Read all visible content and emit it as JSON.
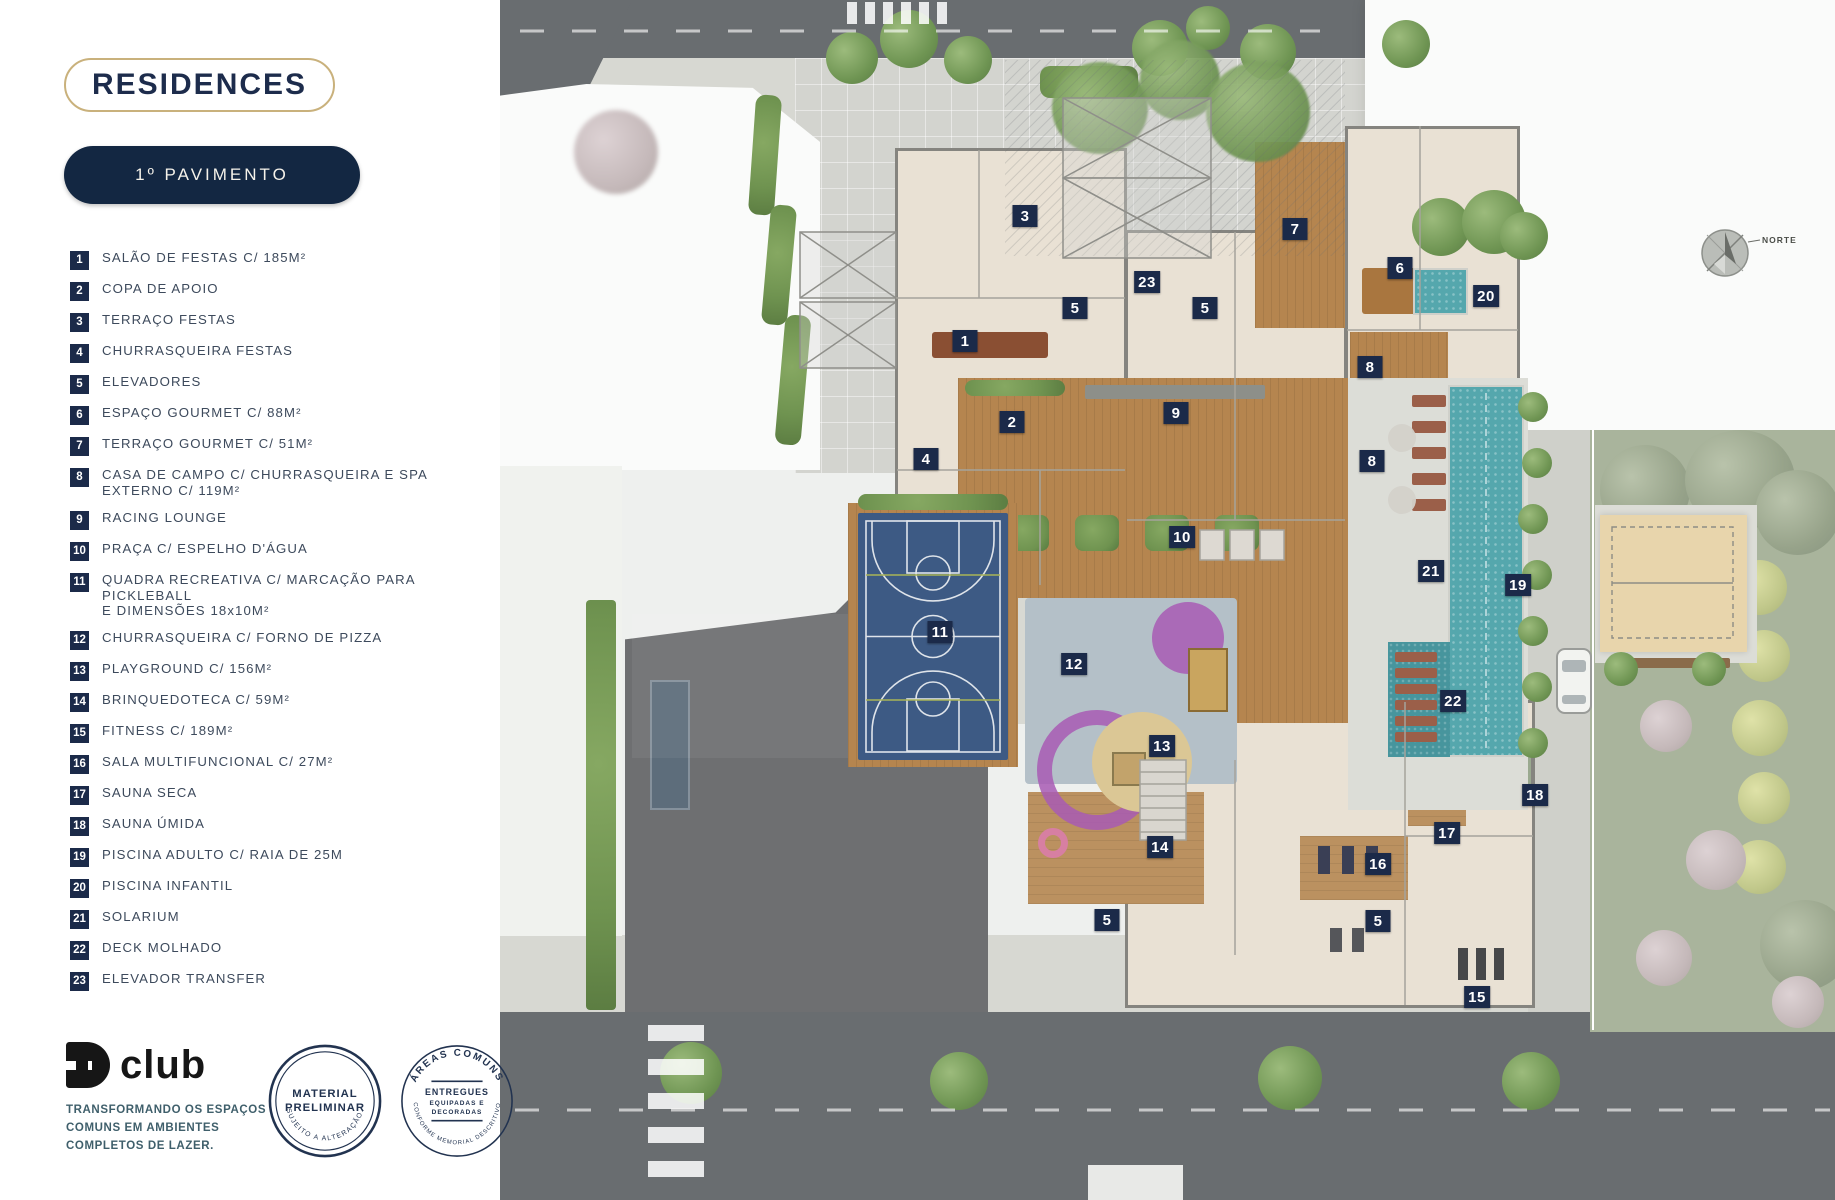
{
  "header": {
    "brand": "RESIDENCES",
    "floor_button": "1º PAVIMENTO"
  },
  "legend": {
    "items": [
      {
        "n": "1",
        "label": "SALÃO DE FESTAS C/ 185M²"
      },
      {
        "n": "2",
        "label": "COPA DE APOIO"
      },
      {
        "n": "3",
        "label": "TERRAÇO FESTAS"
      },
      {
        "n": "4",
        "label": "CHURRASQUEIRA FESTAS"
      },
      {
        "n": "5",
        "label": "ELEVADORES"
      },
      {
        "n": "6",
        "label": "ESPAÇO GOURMET C/ 88M²"
      },
      {
        "n": "7",
        "label": "TERRAÇO GOURMET C/ 51M²"
      },
      {
        "n": "8",
        "label": "CASA DE CAMPO C/ CHURRASQUEIRA E SPA EXTERNO C/ 119M²"
      },
      {
        "n": "9",
        "label": "RACING LOUNGE"
      },
      {
        "n": "10",
        "label": "PRAÇA C/ ESPELHO D'ÁGUA"
      },
      {
        "n": "11",
        "label": "QUADRA RECREATIVA C/ MARCAÇÃO PARA PICKLEBALL\nE DIMENSÕES 18x10M²"
      },
      {
        "n": "12",
        "label": "CHURRASQUEIRA C/ FORNO DE PIZZA"
      },
      {
        "n": "13",
        "label": "PLAYGROUND C/ 156M²"
      },
      {
        "n": "14",
        "label": "BRINQUEDOTECA C/ 59M²"
      },
      {
        "n": "15",
        "label": "FITNESS C/ 189M²"
      },
      {
        "n": "16",
        "label": "SALA MULTIFUNCIONAL C/ 27M²"
      },
      {
        "n": "17",
        "label": "SAUNA SECA"
      },
      {
        "n": "18",
        "label": "SAUNA ÚMIDA"
      },
      {
        "n": "19",
        "label": "PISCINA ADULTO C/ RAIA DE 25M"
      },
      {
        "n": "20",
        "label": "PISCINA INFANTIL"
      },
      {
        "n": "21",
        "label": "SOLARIUM"
      },
      {
        "n": "22",
        "label": "DECK MOLHADO"
      },
      {
        "n": "23",
        "label": "ELEVADOR TRANSFER"
      }
    ]
  },
  "footer": {
    "club_word": "club",
    "tagline_lines": [
      "TRANSFORMANDO OS ESPAÇOS",
      "COMUNS EM AMBIENTES",
      "COMPLETOS DE LAZER."
    ],
    "stamp1": {
      "line1": "MATERIAL",
      "line2": "PRELIMINAR",
      "arc_bottom": "SUJEITO A ALTERAÇÃO."
    },
    "stamp2": {
      "arc_top": "ÁREAS COMUNS",
      "center1": "ENTREGUES",
      "center2": "EQUIPADAS E",
      "center3": "DECORADAS",
      "arc_bottom": "CONFORME MEMORIAL DESCRITIVO"
    }
  },
  "plan": {
    "compass_label": "NORTE",
    "markers": [
      {
        "n": "1",
        "x": 465,
        "y": 341
      },
      {
        "n": "2",
        "x": 512,
        "y": 422
      },
      {
        "n": "3",
        "x": 525,
        "y": 216
      },
      {
        "n": "4",
        "x": 426,
        "y": 459
      },
      {
        "n": "5",
        "x": 575,
        "y": 308
      },
      {
        "n": "5",
        "x": 705,
        "y": 308
      },
      {
        "n": "5",
        "x": 607,
        "y": 920
      },
      {
        "n": "5",
        "x": 878,
        "y": 921
      },
      {
        "n": "6",
        "x": 900,
        "y": 268
      },
      {
        "n": "7",
        "x": 795,
        "y": 229
      },
      {
        "n": "8",
        "x": 870,
        "y": 367
      },
      {
        "n": "8",
        "x": 872,
        "y": 461
      },
      {
        "n": "9",
        "x": 676,
        "y": 413
      },
      {
        "n": "10",
        "x": 682,
        "y": 537
      },
      {
        "n": "11",
        "x": 440,
        "y": 632
      },
      {
        "n": "12",
        "x": 574,
        "y": 664
      },
      {
        "n": "13",
        "x": 662,
        "y": 746
      },
      {
        "n": "14",
        "x": 660,
        "y": 847
      },
      {
        "n": "15",
        "x": 977,
        "y": 997
      },
      {
        "n": "16",
        "x": 878,
        "y": 864
      },
      {
        "n": "17",
        "x": 947,
        "y": 833
      },
      {
        "n": "18",
        "x": 1035,
        "y": 795
      },
      {
        "n": "19",
        "x": 1018,
        "y": 585
      },
      {
        "n": "20",
        "x": 986,
        "y": 296
      },
      {
        "n": "21",
        "x": 931,
        "y": 571
      },
      {
        "n": "22",
        "x": 953,
        "y": 701
      },
      {
        "n": "23",
        "x": 647,
        "y": 282
      }
    ],
    "colors": {
      "badge_navy": "#1b2a49",
      "court_blue": "#3d5a84",
      "pool_teal": "#55a7ad",
      "deck_wood": "#b5854f",
      "playground_purple": "#a85ab4",
      "sand": "#e8d5ac"
    }
  }
}
